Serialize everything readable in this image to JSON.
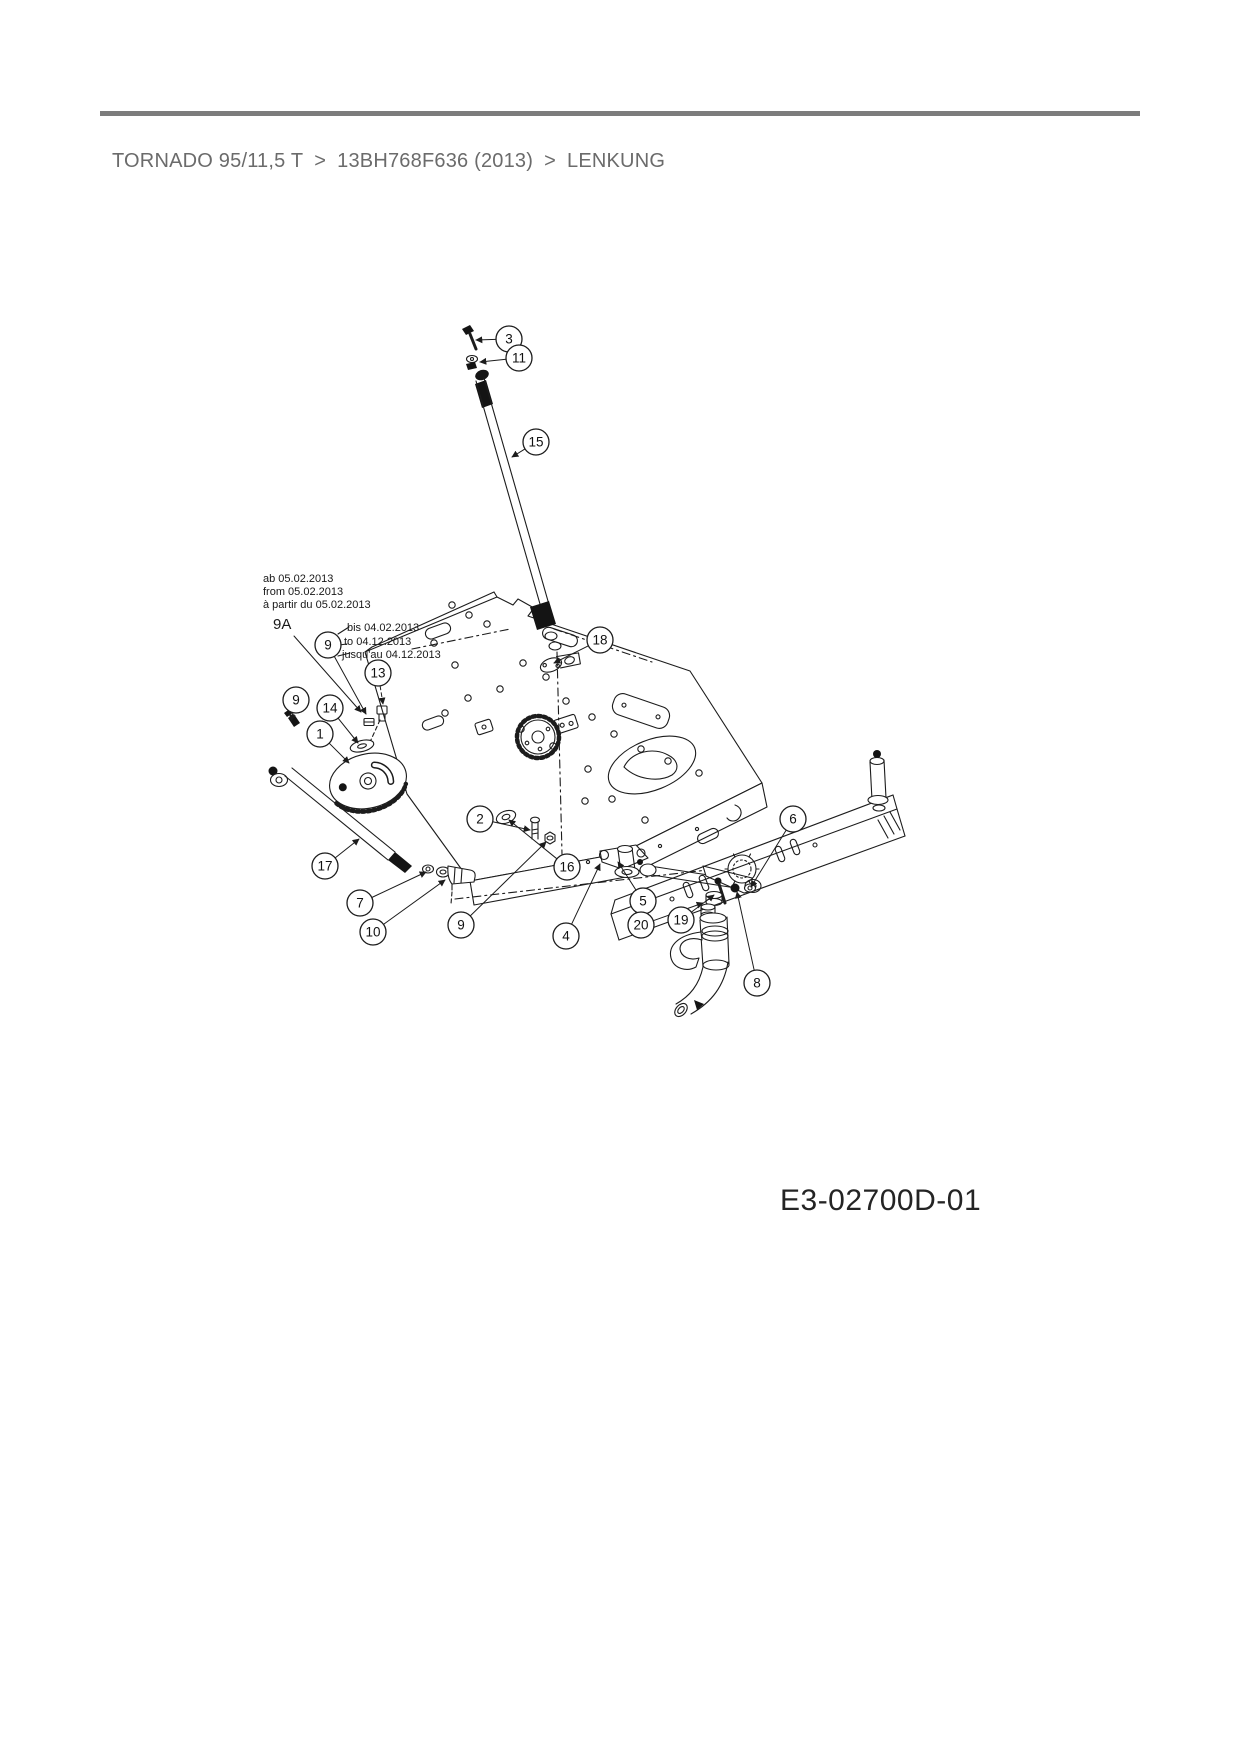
{
  "header": {
    "breadcrumb": {
      "parts": [
        "TORNADO 95/11,5 T",
        "13BH768F636 (2013)",
        "LENKUNG"
      ],
      "separator": ">",
      "color": "#6b6b6b"
    },
    "rule_color": "#7c7c7c"
  },
  "diagram": {
    "code": "E3-02700D-01",
    "line_color": "#1c1c1c",
    "annotations": {
      "from_block": {
        "lines": [
          "ab 05.02.2013",
          "from 05.02.2013",
          "à partir du 05.02.2013"
        ]
      },
      "until_block": {
        "lines": [
          "bis 04.02.2013",
          "to 04.12.2013",
          "jusqu'au 04.12.2013"
        ]
      },
      "variant_label": "9A"
    },
    "callouts": [
      {
        "label": "3",
        "x": 509,
        "y": 339,
        "tx": 476,
        "ty": 340
      },
      {
        "label": "11",
        "x": 519,
        "y": 358,
        "tx": 480,
        "ty": 362
      },
      {
        "label": "15",
        "x": 536,
        "y": 442,
        "tx": 512,
        "ty": 457
      },
      {
        "label": "9",
        "x": 328,
        "y": 645,
        "tx": 366,
        "ty": 714
      },
      {
        "label": "13",
        "x": 378,
        "y": 673,
        "tx": 383,
        "ty": 704,
        "dash": true
      },
      {
        "label": "9",
        "x": 296,
        "y": 700,
        "tx": 291,
        "ty": 721
      },
      {
        "label": "14",
        "x": 330,
        "y": 708,
        "tx": 358,
        "ty": 743
      },
      {
        "label": "1",
        "x": 320,
        "y": 734,
        "tx": 349,
        "ty": 763
      },
      {
        "label": "2",
        "x": 480,
        "y": 819,
        "tx": 530,
        "ty": 830
      },
      {
        "label": "17",
        "x": 325,
        "y": 866,
        "tx": 359,
        "ty": 839
      },
      {
        "label": "7",
        "x": 360,
        "y": 903,
        "tx": 426,
        "ty": 872
      },
      {
        "label": "10",
        "x": 373,
        "y": 932,
        "tx": 445,
        "ty": 880
      },
      {
        "label": "9",
        "x": 461,
        "y": 925,
        "tx": 546,
        "ty": 842
      },
      {
        "label": "4",
        "x": 566,
        "y": 936,
        "tx": 600,
        "ty": 864
      },
      {
        "label": "16",
        "x": 567,
        "y": 867,
        "tx": 509,
        "ty": 820
      },
      {
        "label": "18",
        "x": 600,
        "y": 640,
        "tx": 554,
        "ty": 663
      },
      {
        "label": "5",
        "x": 643,
        "y": 901,
        "tx": 618,
        "ty": 862
      },
      {
        "label": "20",
        "x": 641,
        "y": 925,
        "tx": 703,
        "ty": 903
      },
      {
        "label": "19",
        "x": 681,
        "y": 920,
        "tx": 714,
        "ty": 895
      },
      {
        "label": "6",
        "x": 793,
        "y": 819,
        "tx": 751,
        "ty": 887
      },
      {
        "label": "8",
        "x": 757,
        "y": 983,
        "tx": 737,
        "ty": 892
      }
    ]
  }
}
